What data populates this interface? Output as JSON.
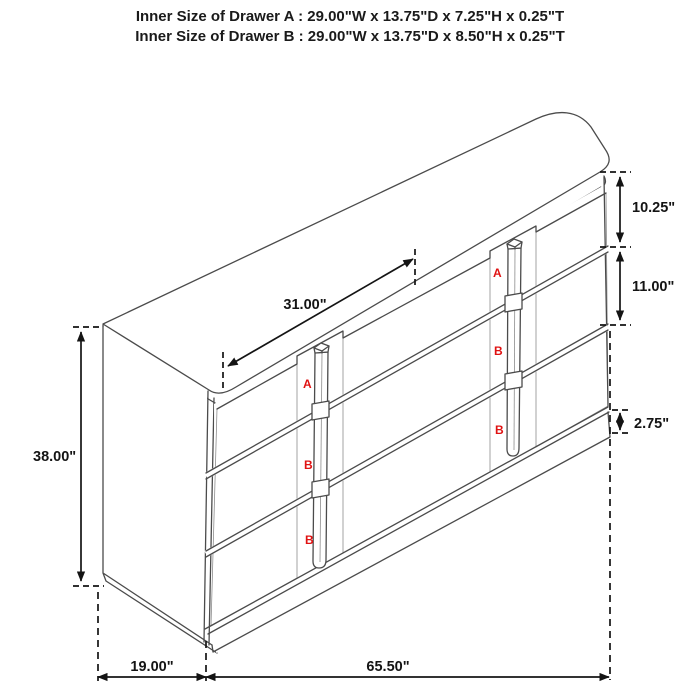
{
  "header": {
    "line_a": "Inner Size of Drawer A : 29.00\"W x 13.75\"D x 7.25\"H x 0.25\"T",
    "line_b": "Inner Size of Drawer B : 29.00\"W x 13.75\"D x 8.50\"H x 0.25\"T"
  },
  "diagram": {
    "dimensions": {
      "drawer_column_width": "31.00\"",
      "top_drawer_height": "10.25\"",
      "middle_drawer_height": "11.00\"",
      "base_height": "2.75\"",
      "overall_height": "38.00\"",
      "overall_depth": "19.00\"",
      "overall_width": "65.50\""
    },
    "drawer_labels": {
      "left": [
        "A",
        "B",
        "B"
      ],
      "right": [
        "A",
        "B",
        "B"
      ]
    },
    "colors": {
      "outline": "#4b4b4b",
      "dimension_text": "#141414",
      "drawer_label": "#e01212",
      "background": "#ffffff"
    }
  }
}
